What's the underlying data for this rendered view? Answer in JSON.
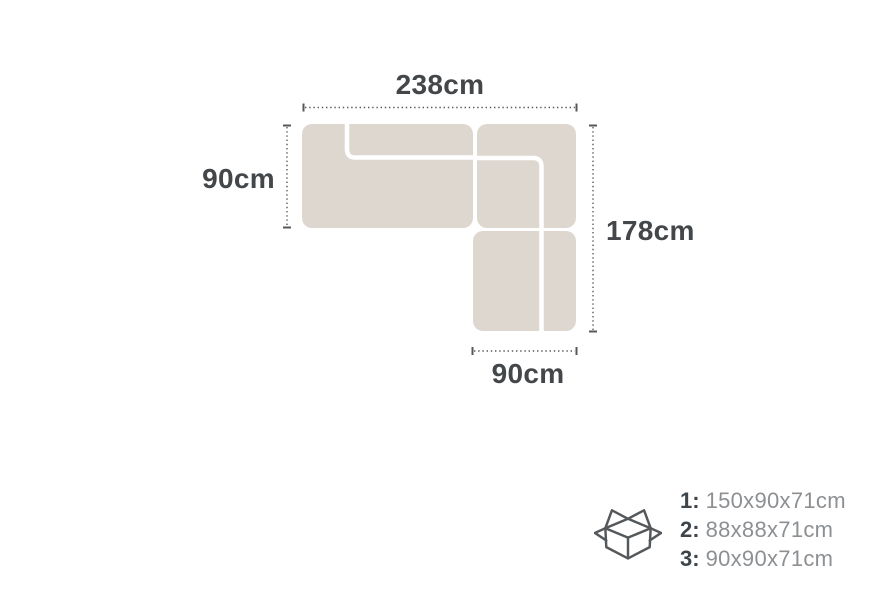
{
  "sofa_diagram": {
    "type": "corner-sofa-top-view",
    "sections": 3,
    "dimensions": {
      "top": "238cm",
      "left": "90cm",
      "right": "178cm",
      "bottom": "90cm"
    }
  },
  "package_info": {
    "icon": "open-box-icon",
    "items": [
      {
        "label": "1:",
        "size": "150x90x71cm"
      },
      {
        "label": "2:",
        "size": "88x88x71cm"
      },
      {
        "label": "3:",
        "size": "90x90x71cm"
      }
    ]
  },
  "colors": {
    "background": "#FFFFFF",
    "sofa_fill": "#DDD7D0",
    "dimension_line": "#55585B",
    "label_text": "#43474A",
    "package_number": "#3F4449",
    "package_size": "#8D9093"
  }
}
